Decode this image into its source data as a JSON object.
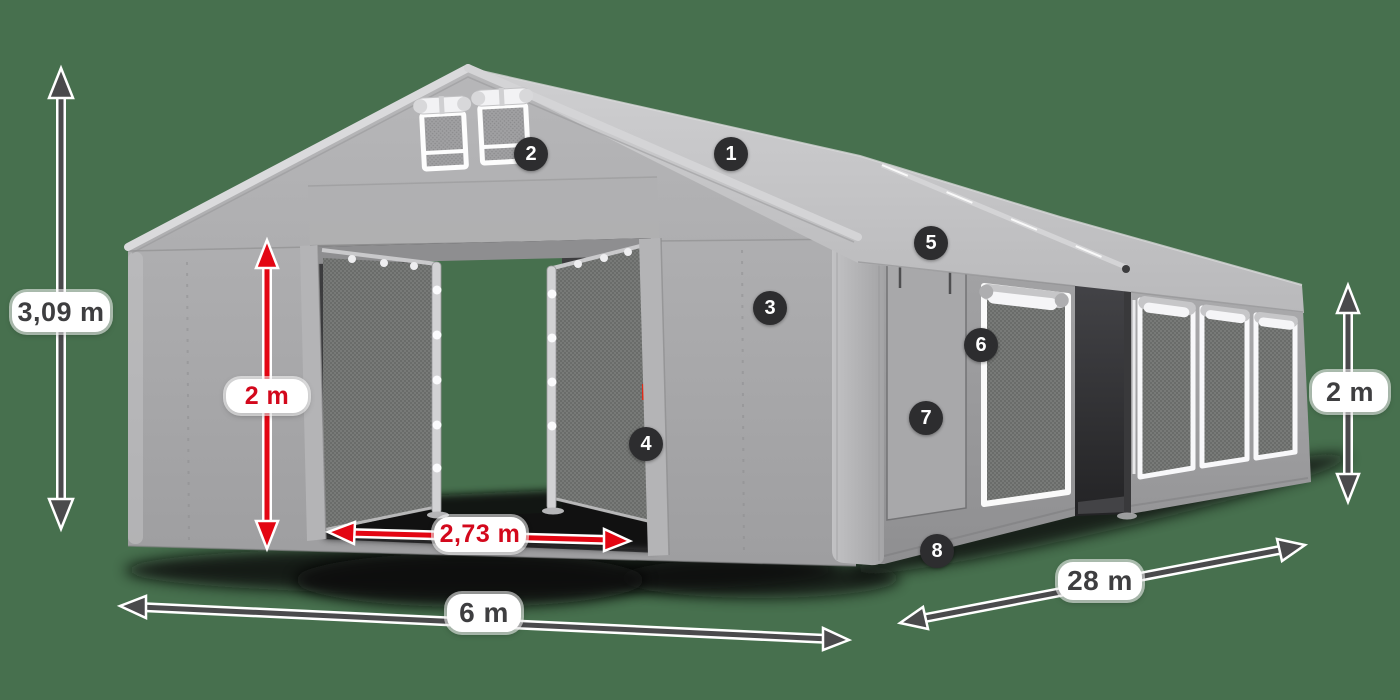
{
  "scene": {
    "background_color": "#47704E"
  },
  "dimensions": {
    "total_height": {
      "label": "3,09 m",
      "color": "#3E3E40"
    },
    "entrance_height": {
      "label": "2 m",
      "color": "#D3081C"
    },
    "entrance_width": {
      "label": "2,73 m",
      "color": "#D3081C"
    },
    "gable_width": {
      "label": "6 m",
      "color": "#3E3E40"
    },
    "side_length": {
      "label": "28 m",
      "color": "#3E3E40"
    },
    "side_height": {
      "label": "2 m",
      "color": "#3E3E40"
    }
  },
  "hotspots": {
    "badge_background": "#2D2D2F",
    "badge_text_color": "#FFFFFF",
    "items": [
      {
        "number": "1"
      },
      {
        "number": "2"
      },
      {
        "number": "3"
      },
      {
        "number": "4"
      },
      {
        "number": "5"
      },
      {
        "number": "6"
      },
      {
        "number": "7"
      },
      {
        "number": "8"
      }
    ]
  },
  "annotation_colors": {
    "arrow_dark": "#4A4A4C",
    "arrow_red": "#E30613",
    "pill_background": "#FFFFFF"
  }
}
